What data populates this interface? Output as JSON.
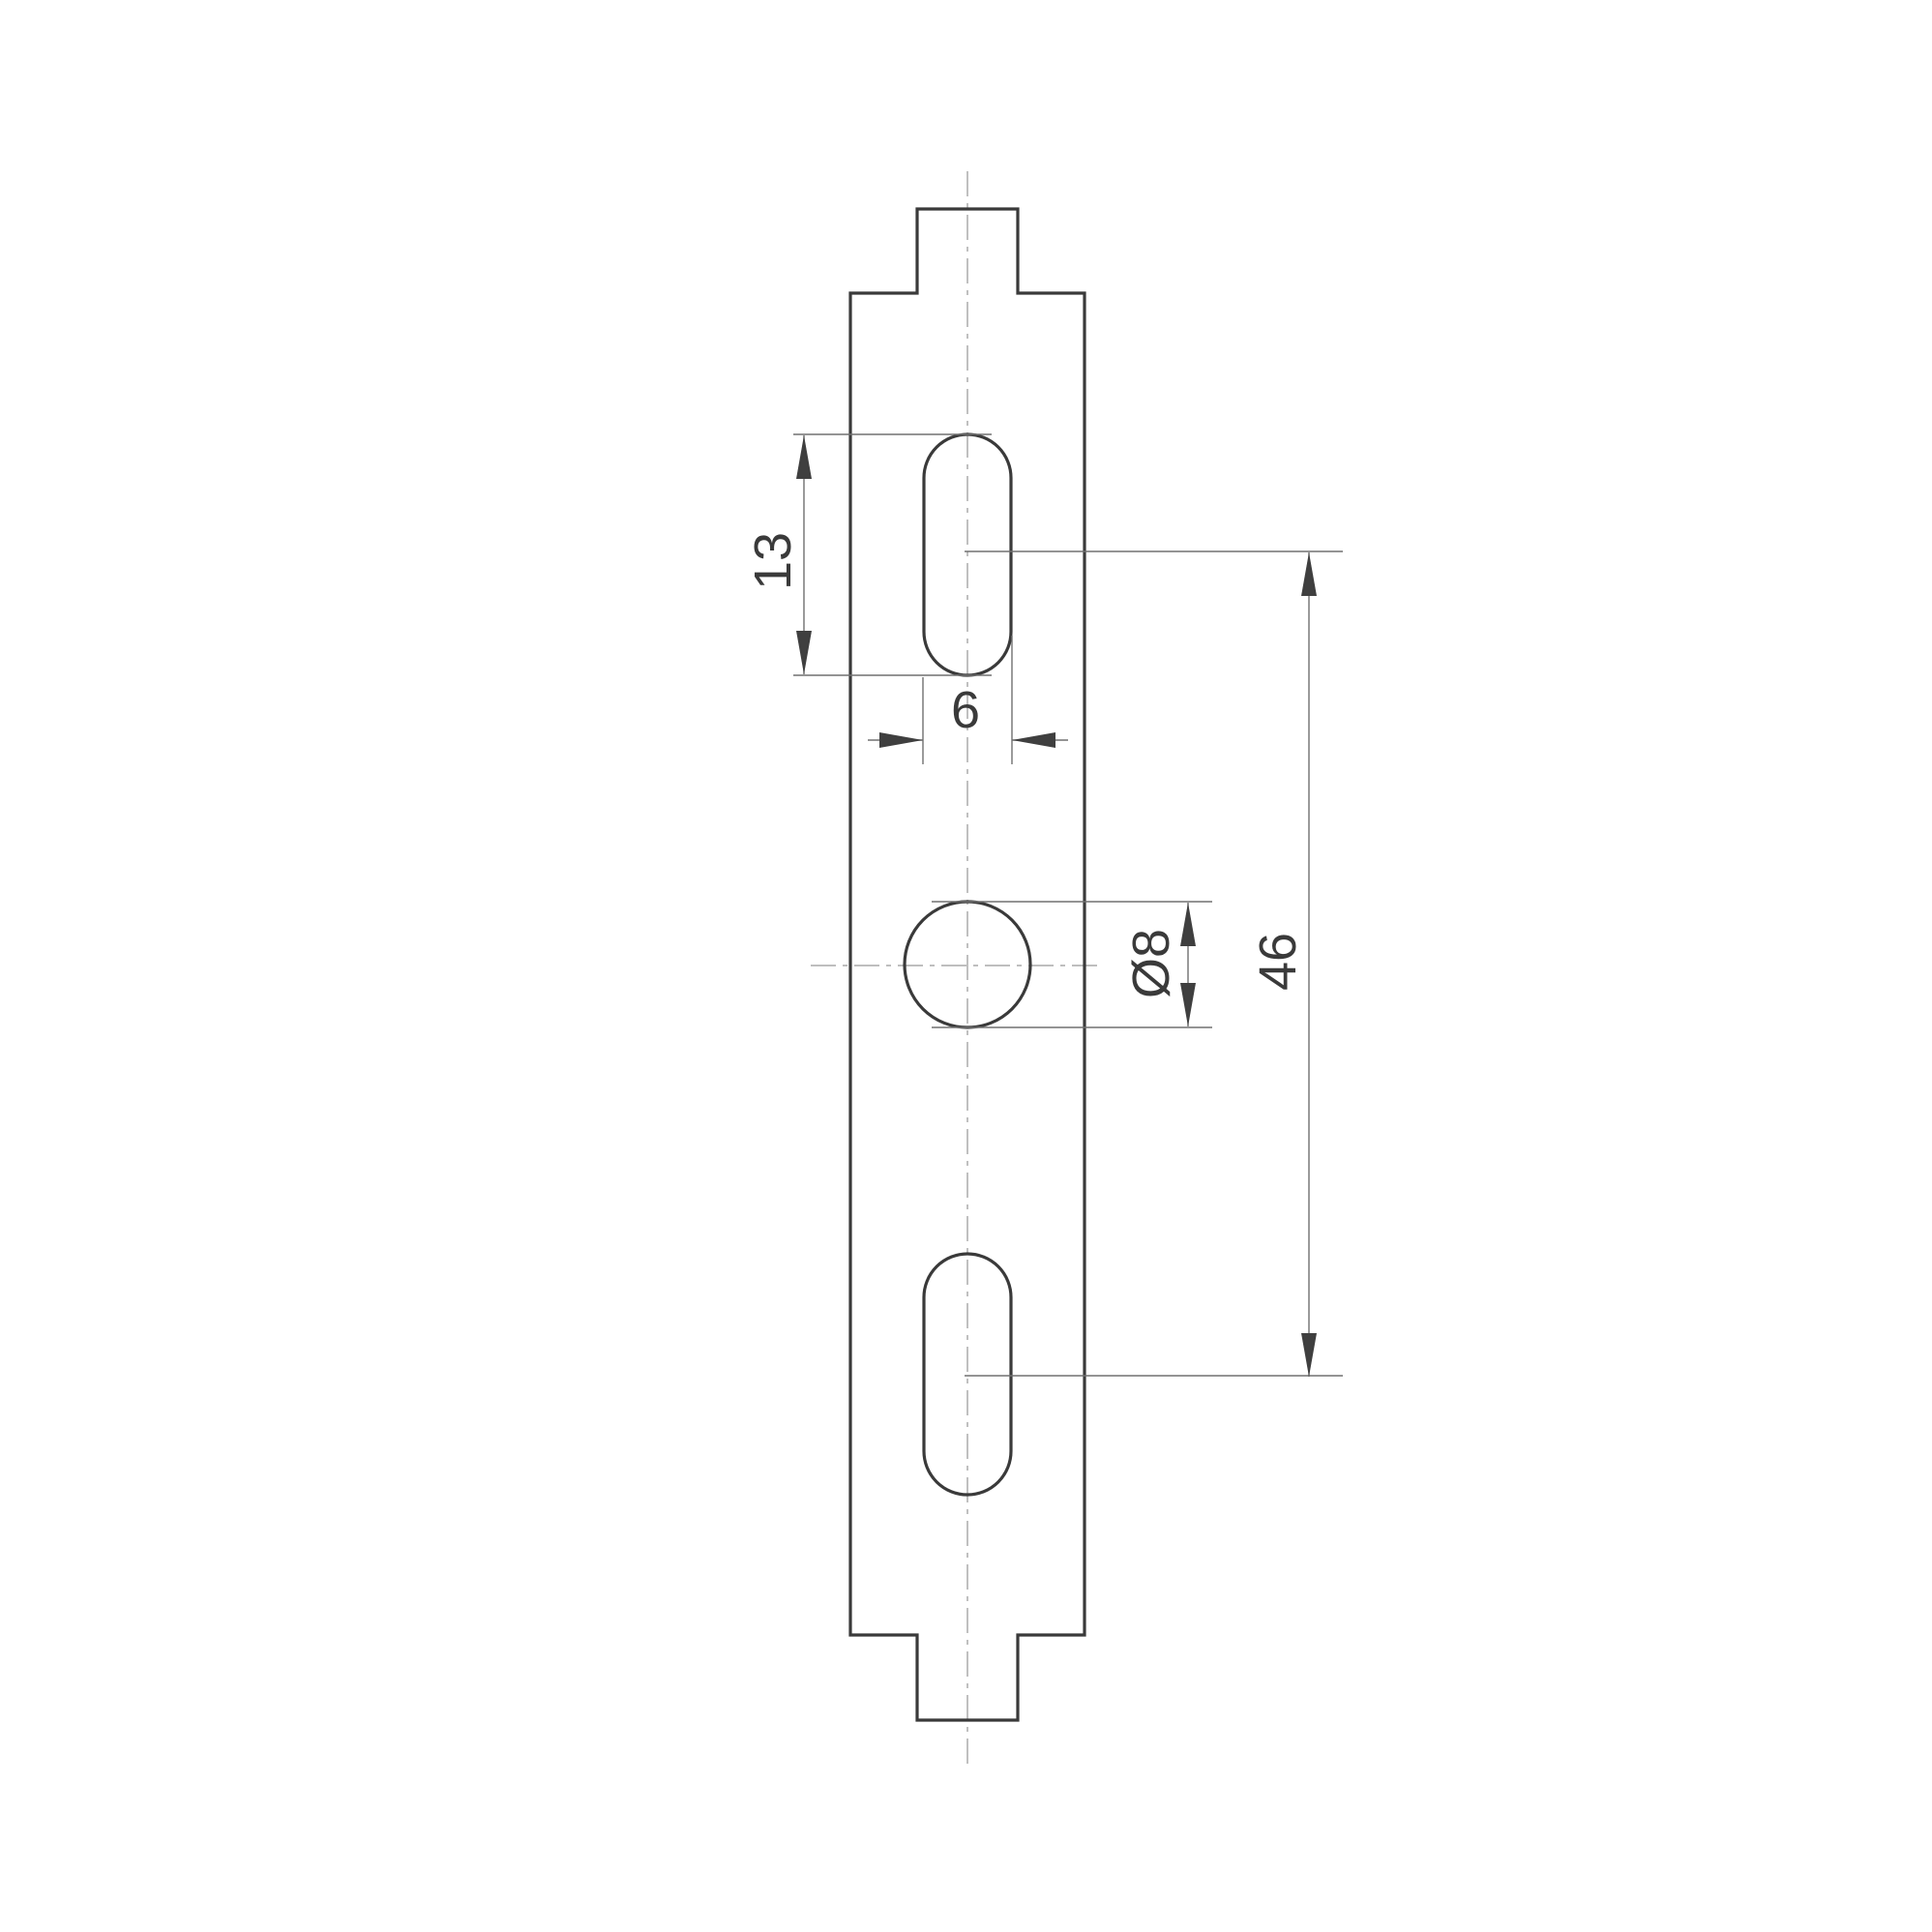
{
  "colors": {
    "background": "#ffffff",
    "outline": "#3a3a3a",
    "dimension": "#707070",
    "arrow": "#3f3f3f",
    "text": "#3a3a3a",
    "centerline": "#b5b5b5"
  },
  "dims": {
    "slot_length": {
      "label": "13"
    },
    "slot_width": {
      "label": "6"
    },
    "hole_diameter": {
      "label": "Ø8"
    },
    "slot_spacing": {
      "label": "46"
    }
  }
}
